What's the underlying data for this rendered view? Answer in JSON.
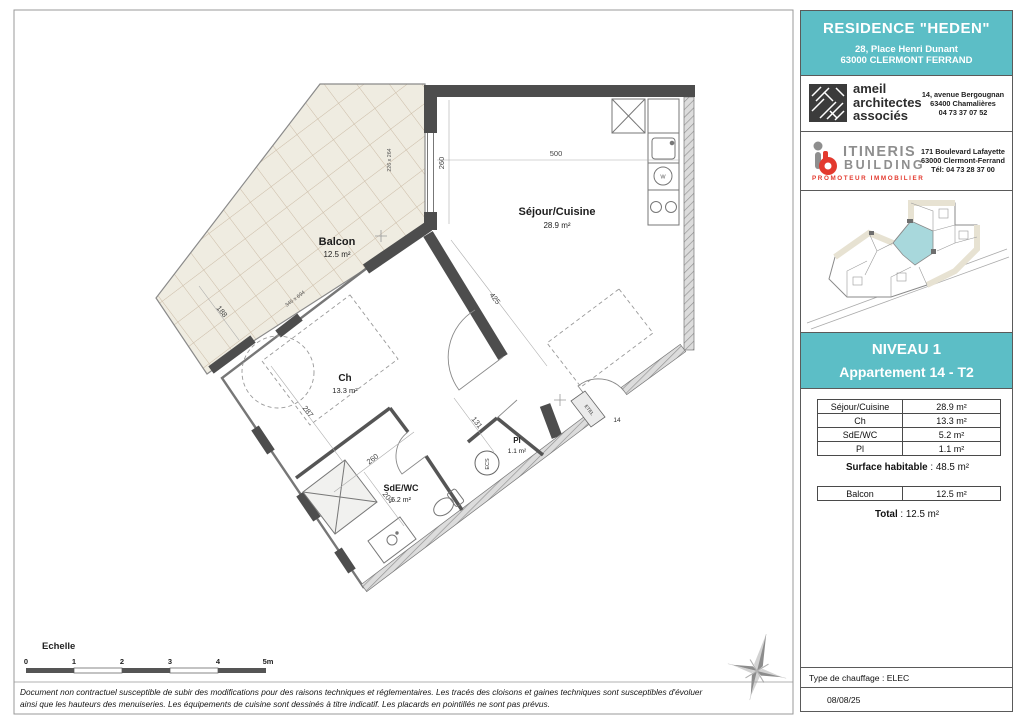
{
  "colors": {
    "teal": "#5CBEC6",
    "wall_dark": "#4D4D4D",
    "balcony_fill": "#EFECE1",
    "tile_line": "#CBBBA6",
    "brand_red": "#E3392E",
    "brand_gray": "#8E8E8E"
  },
  "plan": {
    "rooms": {
      "balcon": {
        "name": "Balcon",
        "area": "12.5 m²"
      },
      "sejour": {
        "name": "Séjour/Cuisine",
        "area": "28.9 m²"
      },
      "ch": {
        "name": "Ch",
        "area": "13.3 m²"
      },
      "sde": {
        "name": "SdE/WC",
        "area": "5.2 m²"
      },
      "pl": {
        "name": "Pl",
        "area": "1.1 m²"
      }
    },
    "dims": {
      "d260": "260",
      "d500": "500",
      "d425": "425",
      "d287": "287",
      "d131": "131",
      "d260b": "260",
      "d204": "204",
      "d188": "188",
      "w1": "226 x 264",
      "w2": "345 x 694"
    },
    "annot": {
      "number": "14",
      "etel": "ETEL",
      "ecs": "ECS",
      "washer": "W"
    }
  },
  "scalebar": {
    "title": "Echelle",
    "t0": "0",
    "t1": "1",
    "t2": "2",
    "t3": "3",
    "t4": "4",
    "t5": "5m"
  },
  "disclaimer": {
    "line1": "Document non contractuel susceptible de subir des modifications pour des raisons techniques et réglementaires. Les tracés des cloisons et gaines techniques sont susceptibles d'évoluer",
    "line2": "ainsi que les hauteurs des menuiseries. Les équipements de cuisine sont dessinés à titre indicatif. Les placards en pointillés ne sont pas prévus."
  },
  "panel": {
    "header": {
      "title": "RESIDENCE \"HEDEN\"",
      "address1": "28, Place Henri Dunant",
      "address2": "63000 CLERMONT FERRAND"
    },
    "architect": {
      "l1": "ameil",
      "l2": "architectes",
      "l3": "associés",
      "a1": "14, avenue Bergougnan",
      "a2": "63400 Chamalières",
      "a3": "04 73 37 07 52"
    },
    "developer": {
      "n1": "ITINERIS",
      "n2": "BUILDING",
      "tag": "PROMOTEUR IMMOBILIER",
      "a1": "171 Boulevard Lafayette",
      "a2": "63000 Clermont-Ferrand",
      "a3": "Tél: 04 73 28 37 00"
    },
    "level": {
      "l1": "NIVEAU 1",
      "l2": "Appartement 14 - T2"
    },
    "areas": {
      "rows": [
        {
          "label": "Séjour/Cuisine",
          "value": "28.9 m²"
        },
        {
          "label": "Ch",
          "value": "13.3 m²"
        },
        {
          "label": "SdE/WC",
          "value": "5.2 m²"
        },
        {
          "label": "Pl",
          "value": "1.1 m²"
        }
      ],
      "surface_label": "Surface habitable",
      "surface_sep": " : ",
      "surface_value": "48.5 m²",
      "balcon_label": "Balcon",
      "balcon_value": "12.5 m²",
      "total_label": "Total",
      "total_sep": " : ",
      "total_value": "12.5 m²"
    },
    "heating": "Type de chauffage : ELEC",
    "date": "08/08/25"
  }
}
